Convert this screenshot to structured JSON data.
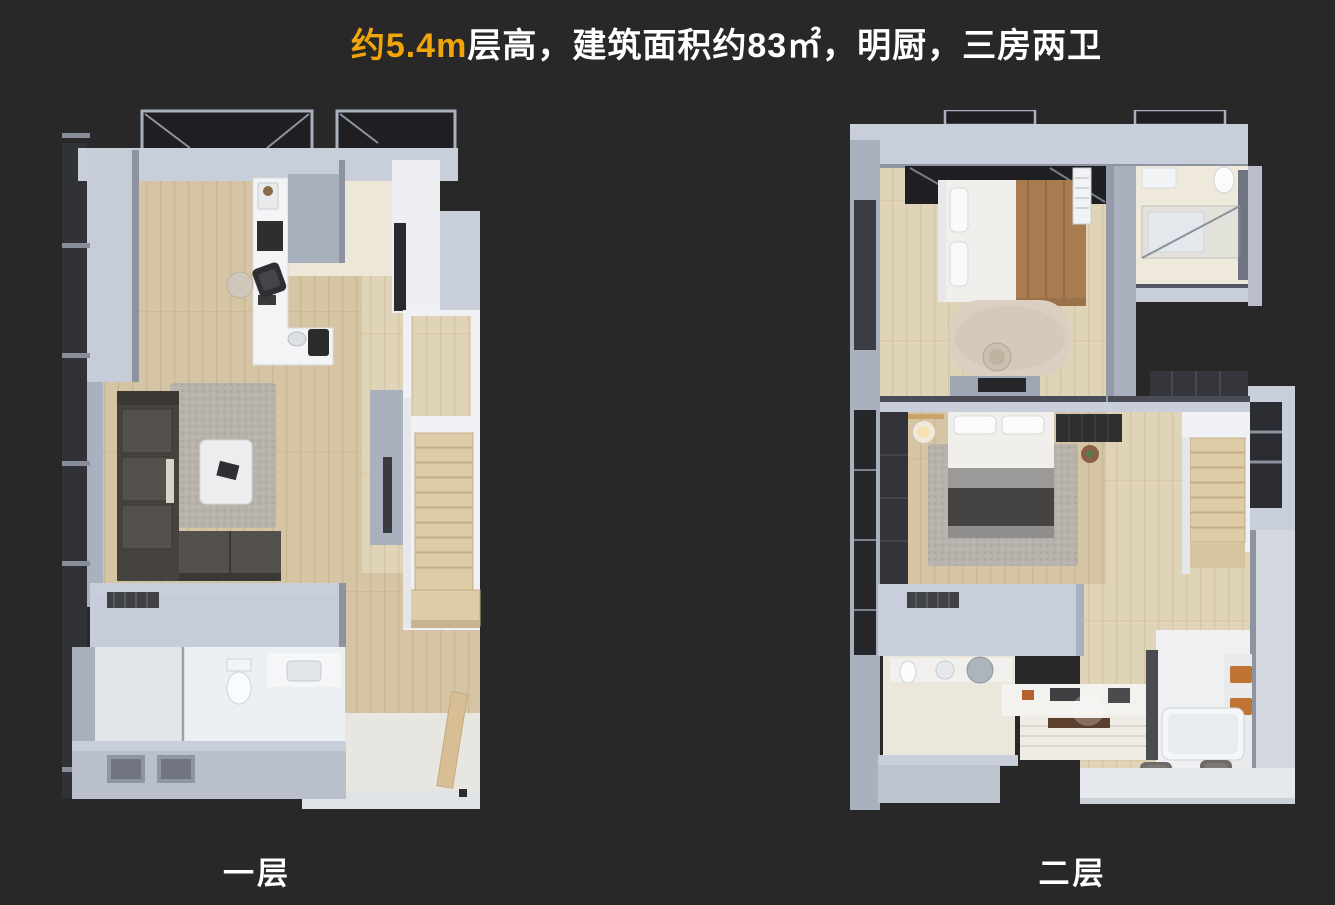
{
  "header": {
    "highlight": "约5.4m",
    "rest": "层高，建筑面积约83㎡，明厨，三房两卫"
  },
  "floors": [
    {
      "label": "一层"
    },
    {
      "label": "二层"
    }
  ],
  "colors": {
    "background": "#282828",
    "accent_orange": "#F2A50A",
    "title_text": "#FFFFFF",
    "wall_top": "#C9CFDA",
    "wall_side": "#A9B0BE",
    "wall_shadow": "#8D93A1",
    "surface_white": "#F3F4F6",
    "floor_wood": "#D5C5A5",
    "floor_cream": "#EDE7D8",
    "stair_wood": "#DECCA8",
    "sofa_dark": "#46423D",
    "duvet_dark": "#454443",
    "bed_blanket_brown": "#A97C50",
    "rug_gray": "#B7B2AB",
    "rug_cream": "#DACFC0",
    "towel_orange": "#BF7434",
    "glass_dark": "#1F1F23"
  }
}
